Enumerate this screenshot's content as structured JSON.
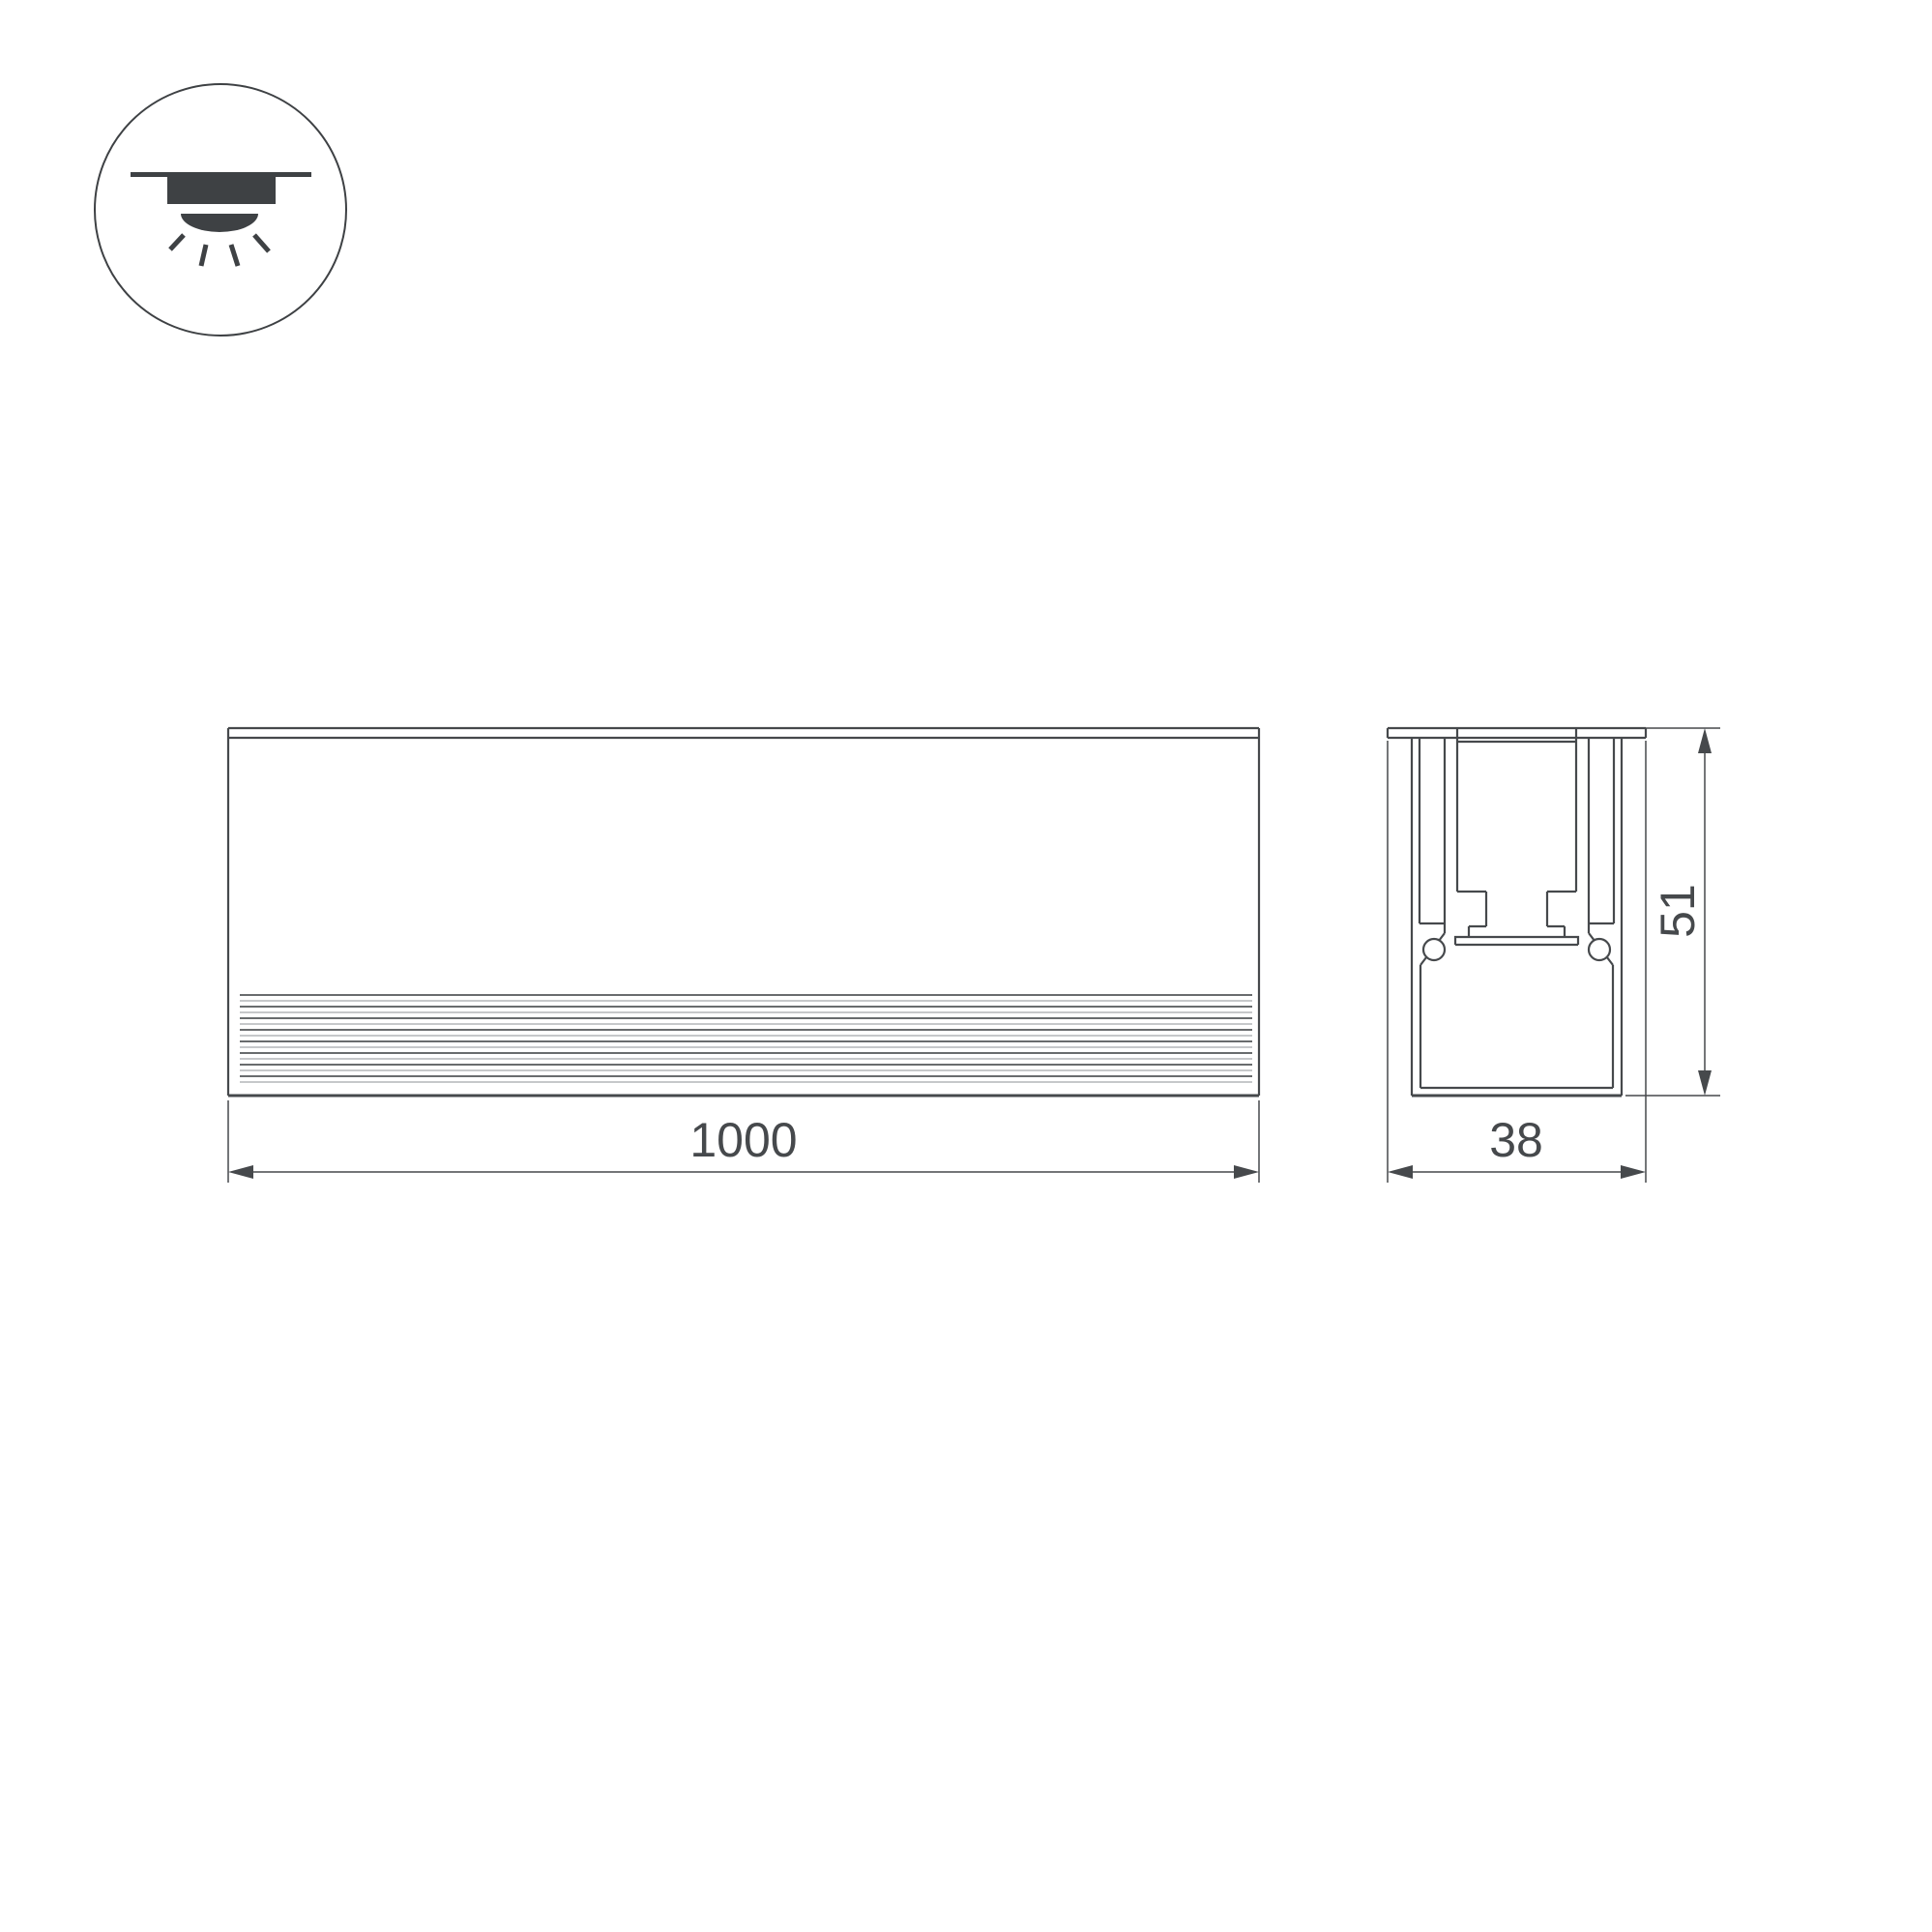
{
  "colors": {
    "canvas": "#ffffff",
    "line": "#46494c",
    "text": "#46494c",
    "icon": "#3e4144",
    "stripe_dark": "#54575a",
    "stripe_light": "#8e9194"
  },
  "icon": {
    "label": "recessed-downlight-icon"
  },
  "front_view": {
    "width_dimension": "1000"
  },
  "section_view": {
    "width_dimension": "38",
    "height_dimension": "51"
  }
}
